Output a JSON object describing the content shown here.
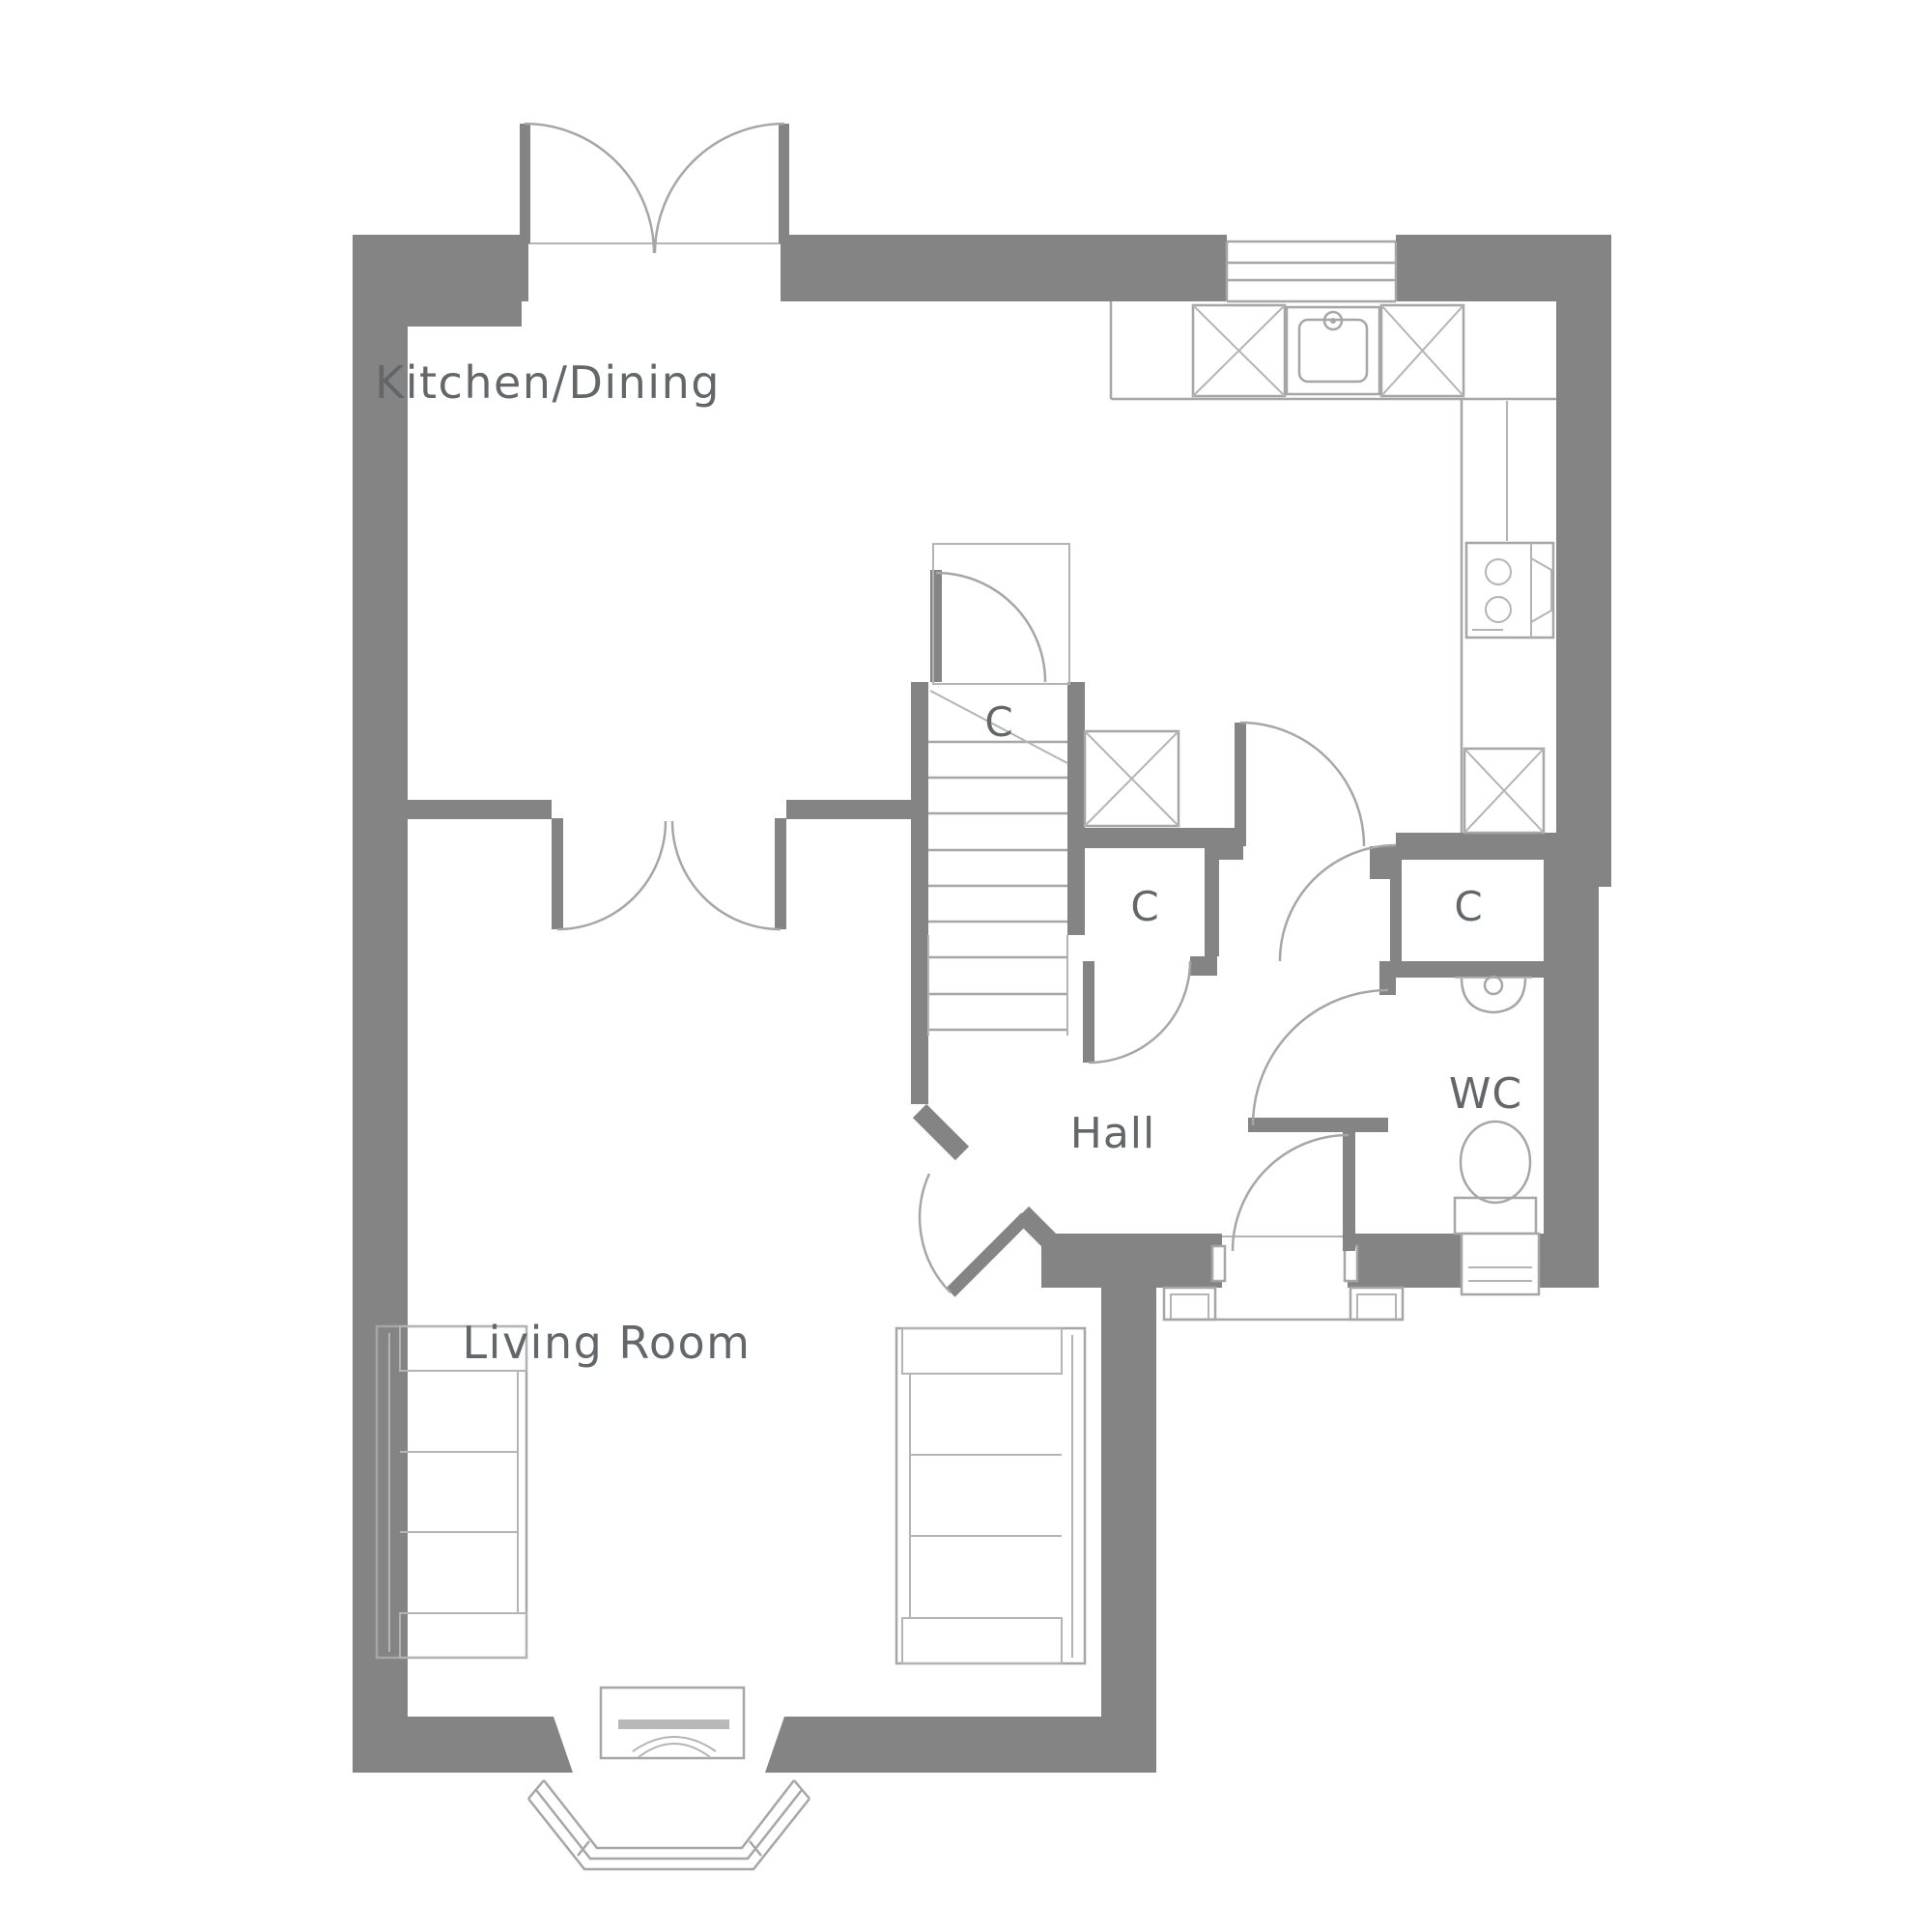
{
  "plan": {
    "type": "floor-plan",
    "floor": "ground-floor",
    "colors": {
      "wall": "#848484",
      "line": "#a6a6a6",
      "line_light": "#b4b4b4",
      "text": "#63676a",
      "fireplace_bar": "#b9b9b9",
      "background": "#ffffff"
    },
    "rooms": {
      "kitchen_dining": {
        "label": "Kitchen/Dining"
      },
      "living_room": {
        "label": "Living Room"
      },
      "hall": {
        "label": "Hall"
      },
      "wc": {
        "label": "WC"
      }
    },
    "closets": {
      "under_stairs": {
        "label": "C"
      },
      "middle": {
        "label": "C"
      },
      "right": {
        "label": "C"
      }
    },
    "features": [
      "french-doors-top",
      "kitchen-window",
      "kitchen-counter-top",
      "kitchen-counter-right",
      "sink",
      "hob",
      "appliance-x-boxes",
      "stairs",
      "stairs-landing-door",
      "kitchen-hall-door",
      "double-doors-kitchen-living",
      "living-hall-diagonal-door",
      "wc-toilet",
      "wc-basin",
      "wc-vanity-unit",
      "front-door",
      "porch-pillars",
      "bay-window",
      "fireplace",
      "sofa-left",
      "sofa-right"
    ]
  }
}
